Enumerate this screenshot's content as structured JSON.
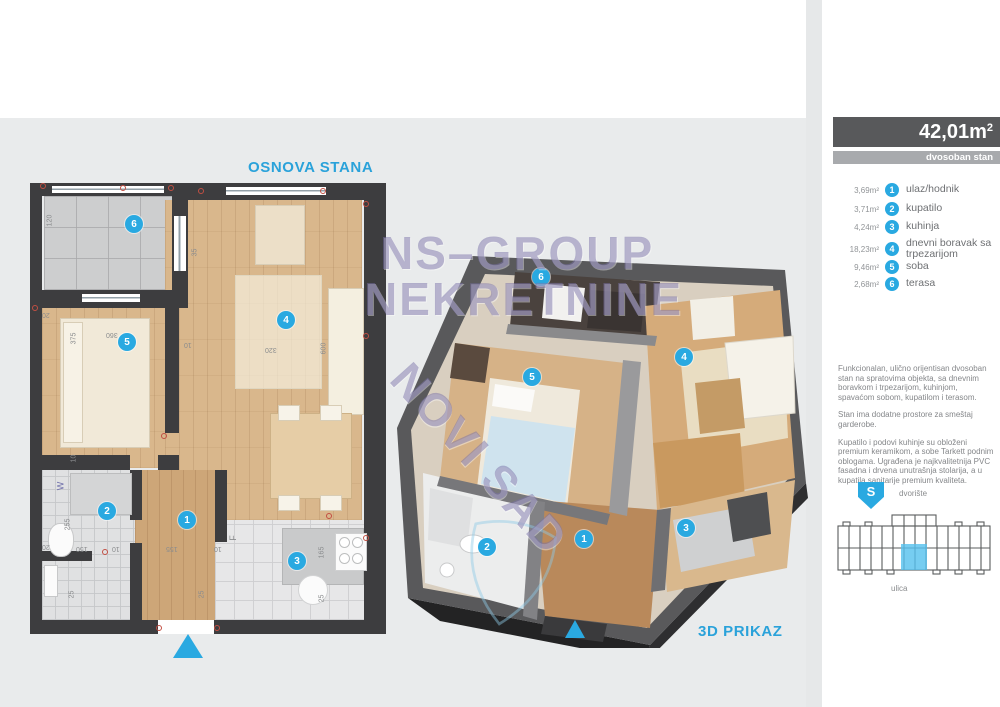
{
  "header": {
    "area_value": "42,01m",
    "area_exp": "2",
    "type_label": "dvosoban stan"
  },
  "legend": {
    "rooms": [
      {
        "num": "1",
        "area": "3,69m²",
        "label": "ulaz/hodnik"
      },
      {
        "num": "2",
        "area": "3,71m²",
        "label": "kupatilo"
      },
      {
        "num": "3",
        "area": "4,24m²",
        "label": "kuhinja"
      },
      {
        "num": "4",
        "area": "18,23m²",
        "label": "dnevni boravak sa trpezarijom"
      },
      {
        "num": "5",
        "area": "9,46m²",
        "label": "soba"
      },
      {
        "num": "6",
        "area": "2,68m²",
        "label": "terasa"
      }
    ]
  },
  "description": {
    "p1": "Funkcionalan, ulično orijentisan dvosoban stan na spratovima objekta, sa dnevnim boravkom i trpezarijom, kuhinjom, spavaćom sobom, kupatilom i terasom.",
    "p2": "Stan ima dodatne prostore za smeštaj garderobe.",
    "p3": "Kupatilo i podovi kuhinje su obloženi premium keramikom, a sobe Tarkett podnim oblogama. Ugrađena je najkvalitetnija PVC fasadna i drvena unutrašnja stolarija, a u kupatila sanitarije premium kvaliteta."
  },
  "locator": {
    "compass_letter": "S",
    "courtyard_label": "dvorište",
    "street_label": "ulica"
  },
  "plan2d": {
    "title": "OSNOVA STANA",
    "washer_label": "W",
    "fridge_label": "F",
    "dims": {
      "d120": "120",
      "d35": "35",
      "d20a": "20",
      "d375": "375",
      "d360": "360",
      "d10a": "10",
      "d320": "320",
      "d600": "600",
      "d10d": "10",
      "d255": "255",
      "d20b": "20",
      "d150": "150",
      "d10b": "10",
      "d155": "155",
      "d10c": "10",
      "d165": "165",
      "d25a": "25",
      "d25b": "25",
      "d25c": "25"
    }
  },
  "plan3d": {
    "title": "3D PRIKAZ"
  },
  "watermark": {
    "line1": "NS–GROUP",
    "line2": "NEKRETNINE",
    "line3": "NOVI SAD"
  },
  "colors": {
    "accent": "#29a9e1",
    "bar_dark": "#58595b",
    "bar_light": "#a8aaad",
    "wall": "#3d3d3f",
    "watermark": "#7b74a8"
  }
}
